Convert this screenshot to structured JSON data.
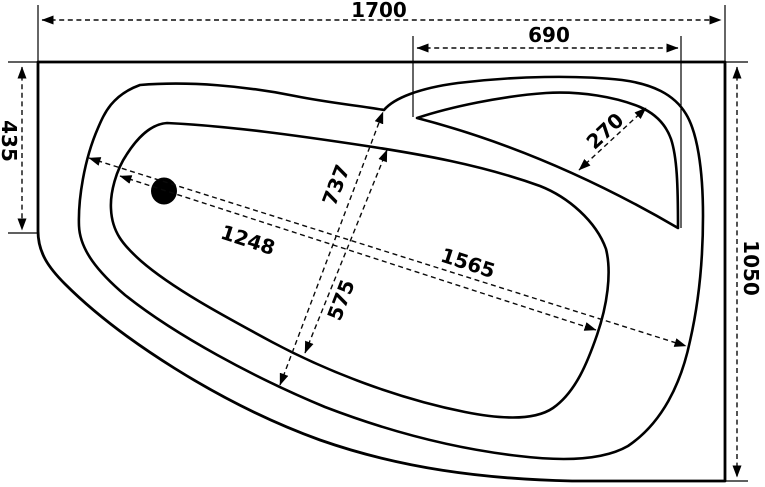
{
  "drawing": {
    "subject": "asymmetric corner bathtub - top view technical drawing",
    "unit": "mm",
    "colors": {
      "line": "#000000",
      "background": "#ffffff"
    },
    "dimensions": {
      "overall_length": "1700",
      "seat_section_length": "690",
      "left_edge_straight": "435",
      "overall_width": "1050",
      "seat_diagonal_width": "270",
      "rim_diagonal_width": "737",
      "basin_diagonal_width": "575",
      "basin_diagonal_length": "1248",
      "rim_diagonal_length": "1565"
    }
  }
}
